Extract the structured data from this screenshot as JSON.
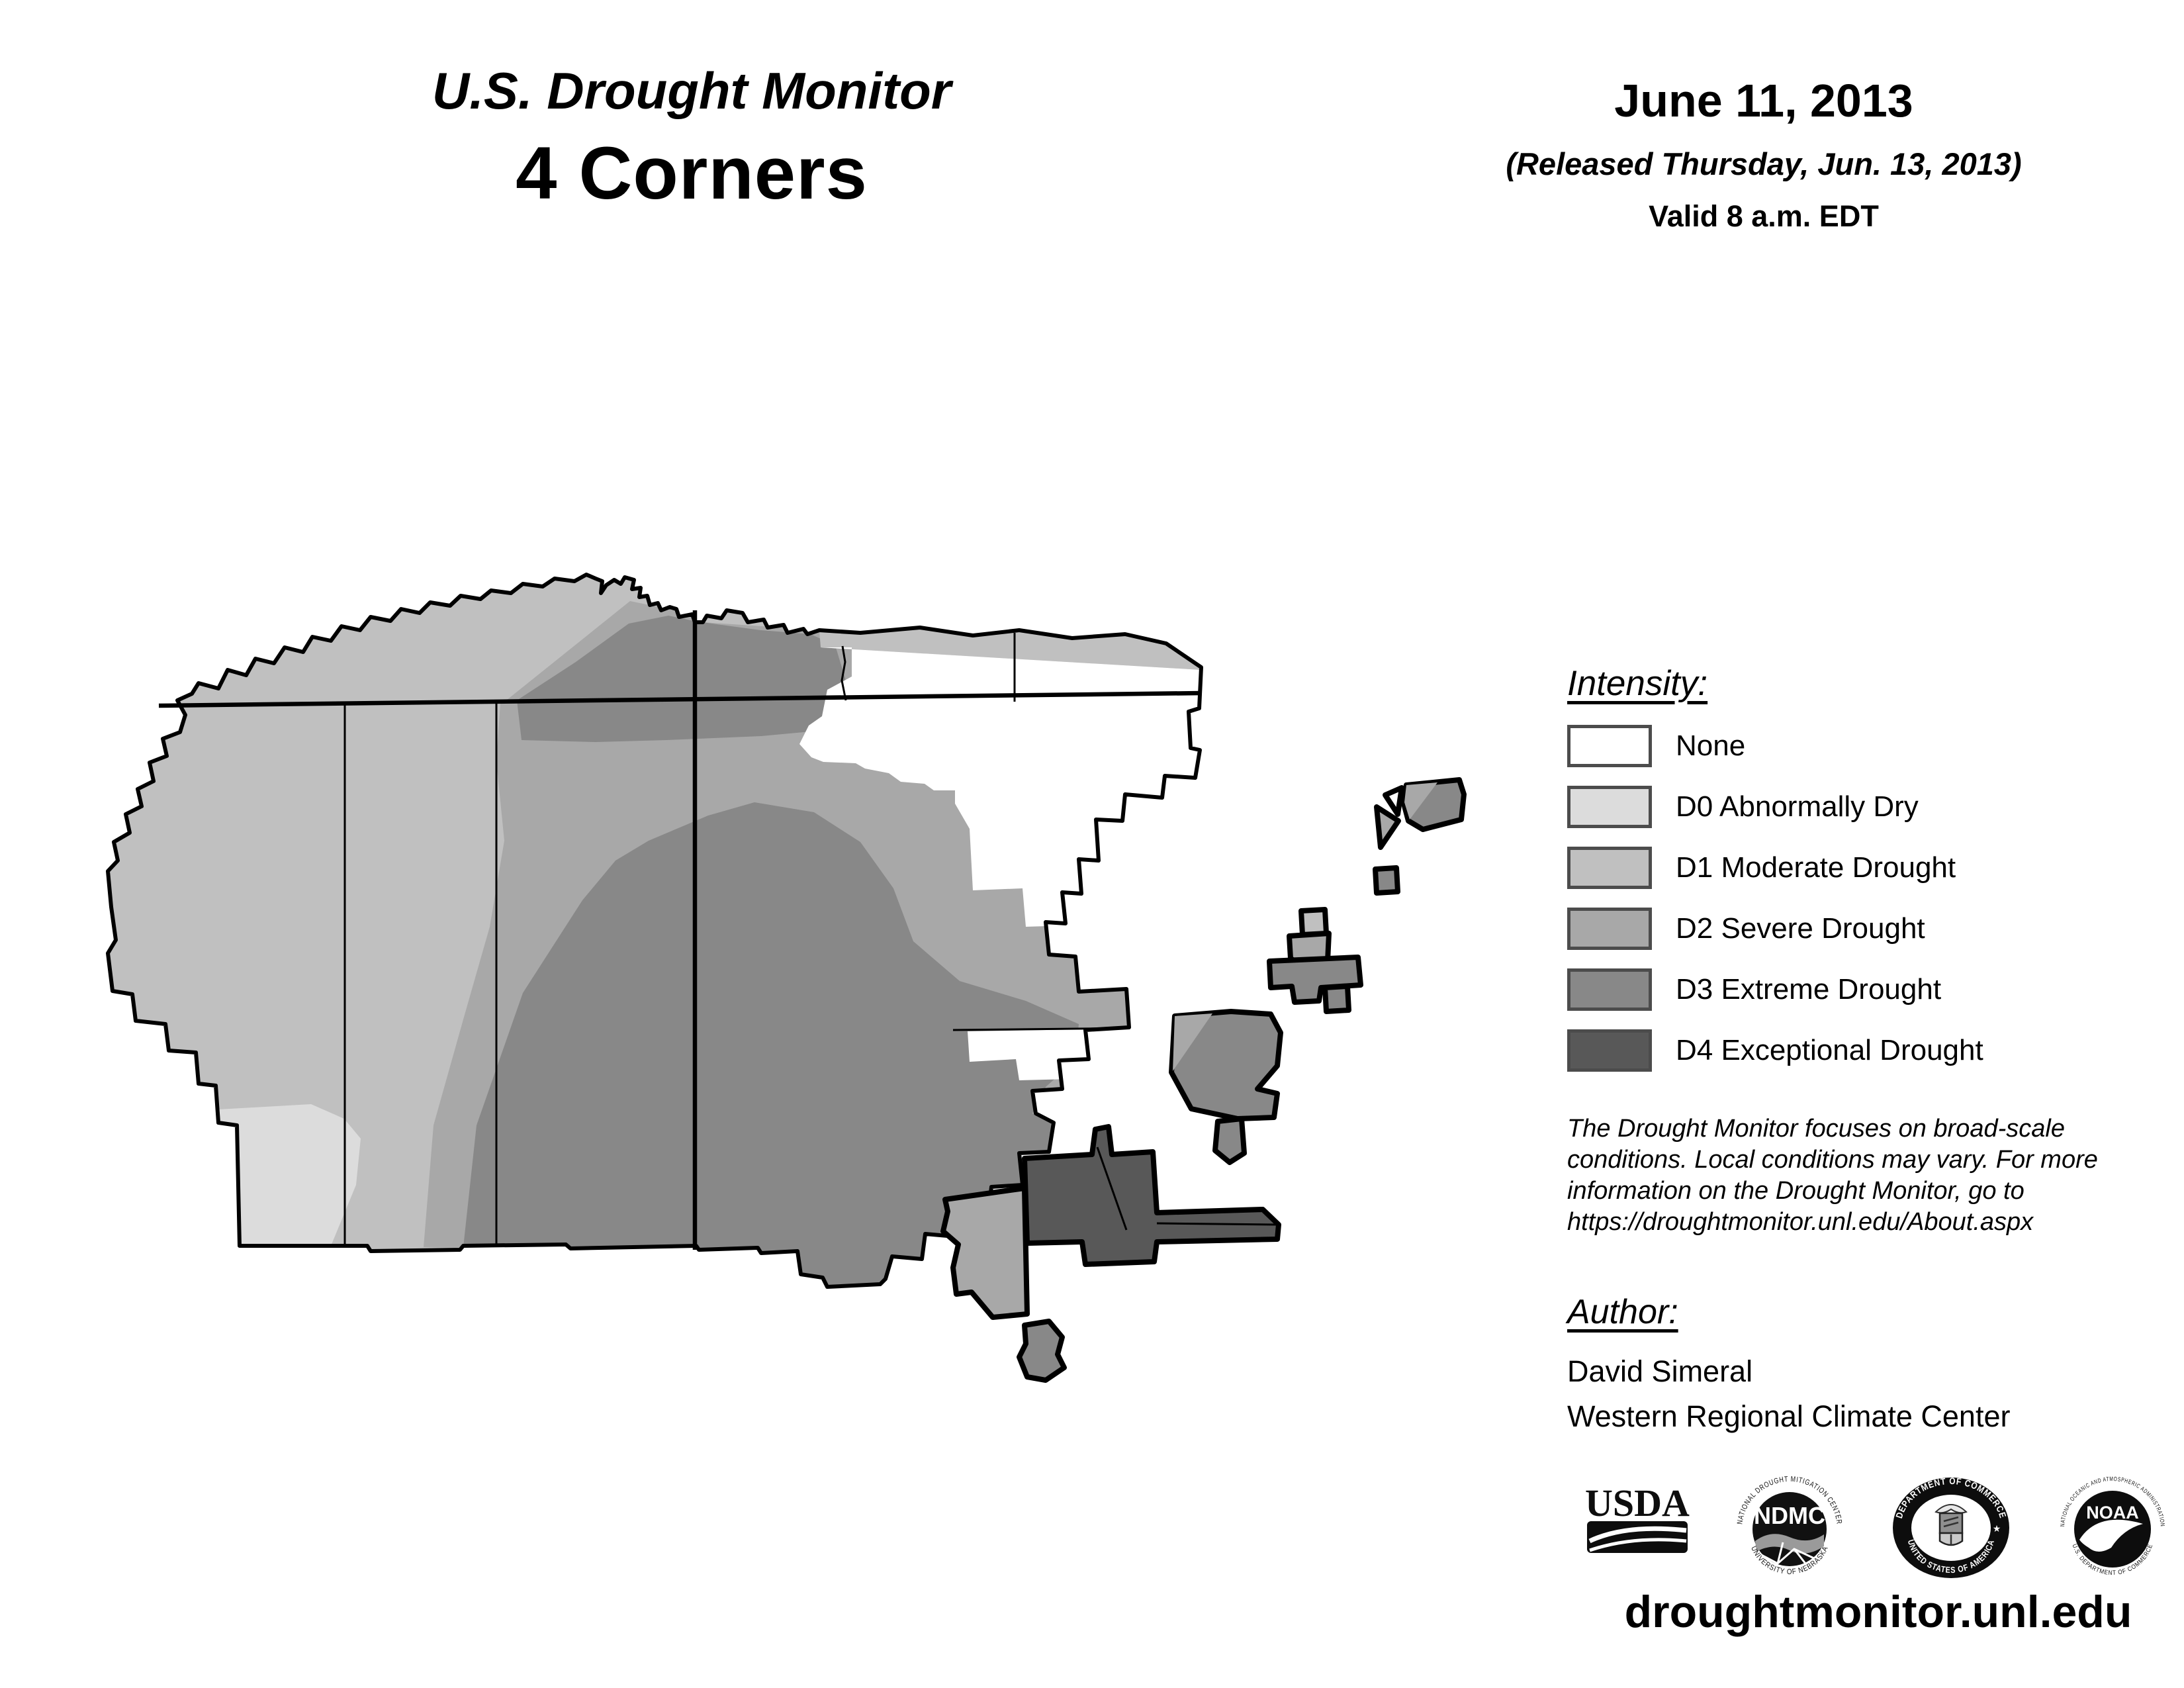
{
  "header": {
    "title_line1": "U.S. Drought Monitor",
    "title_line2": "4 Corners",
    "date": "June 11, 2013",
    "released": "(Released Thursday, Jun. 13, 2013)",
    "valid": "Valid 8 a.m. EDT"
  },
  "legend": {
    "heading": "Intensity:",
    "items": [
      {
        "code": "none",
        "label": "None",
        "color": "#ffffff"
      },
      {
        "code": "d0",
        "label": "D0 Abnormally Dry",
        "color": "#dcdcdc"
      },
      {
        "code": "d1",
        "label": "D1 Moderate Drought",
        "color": "#c0c0c0"
      },
      {
        "code": "d2",
        "label": "D2 Severe Drought",
        "color": "#a8a8a8"
      },
      {
        "code": "d3",
        "label": "D3 Extreme Drought",
        "color": "#888888"
      },
      {
        "code": "d4",
        "label": "D4 Exceptional Drought",
        "color": "#585858"
      }
    ]
  },
  "disclaimer": {
    "lines": [
      "The Drought Monitor focuses on broad-scale",
      "conditions. Local conditions may vary. For more",
      "information on the Drought Monitor, go to",
      "https://droughtmonitor.unl.edu/About.aspx"
    ]
  },
  "author": {
    "heading": "Author:",
    "name": "David Simeral",
    "org": "Western Regional Climate Center"
  },
  "logos": {
    "usda": {
      "text": "USDA"
    },
    "ndmc": {
      "text": "NDMC",
      "ring_top": "NATIONAL DROUGHT MITIGATION CENTER",
      "ring_bottom": "UNIVERSITY OF NEBRASKA"
    },
    "doc": {
      "ring_top": "DEPARTMENT OF COMMERCE",
      "ring_bottom": "UNITED STATES OF AMERICA"
    },
    "noaa": {
      "text": "NOAA",
      "ring_top": "NATIONAL OCEANIC AND ATMOSPHERIC ADMINISTRATION",
      "ring_bottom": "U.S. DEPARTMENT OF COMMERCE"
    }
  },
  "footer": {
    "url": "droughtmonitor.unl.edu"
  },
  "map": {
    "colors": {
      "none": "#ffffff",
      "d0_abnormally_dry": "#dcdcdc",
      "d1_moderate_drought": "#c0c0c0",
      "d2_severe_drought": "#a8a8a8",
      "d3_extreme_drought": "#888888",
      "d4_exceptional_drought": "#585858",
      "boundary": "#000000"
    }
  }
}
